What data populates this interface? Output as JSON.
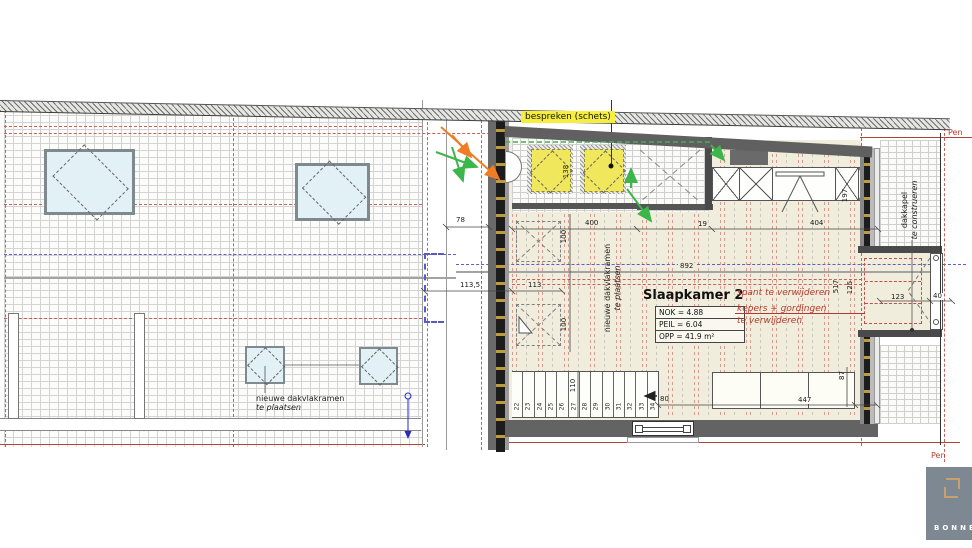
{
  "annotations": {
    "bespreken": "bespreken (schets)",
    "spant": "spant te verwijderen",
    "kepers_1": "kepers + gordingen",
    "kepers_2": "te verwijderen",
    "new_sky_1": "nieuwe dakvlakramen",
    "new_sky_2": "te plaatsen",
    "vert_sky_1": "nieuwe dakvlakramen",
    "vert_sky_2": "te plaatsen",
    "dakkapel_1": "dakkapel",
    "dakkapel_2": "te construeren",
    "boundary_top": "Pen",
    "boundary_bottom": "Pen"
  },
  "room": {
    "name": "Slaapkamer 2",
    "info": {
      "nok": "NOK = 4.88",
      "peil": "PEIL = 6.04",
      "opp": "OPP = 41.9 m²"
    }
  },
  "dimensions": {
    "w78": "78",
    "w113_5": "113,5",
    "w113": "113",
    "h138": "138",
    "h100_top": "100",
    "h100_bottom": "100",
    "w400": "400",
    "w19": "19",
    "w404": "404",
    "h197": "197",
    "w892": "892",
    "h110": "110",
    "w80": "80",
    "w447": "447",
    "h87": "87",
    "h517": "517",
    "h125": "125",
    "w123": "123",
    "w40": "40"
  },
  "stairs": {
    "treads": [
      "22",
      "23",
      "24",
      "25",
      "26",
      "27",
      "28",
      "29",
      "30",
      "31",
      "32",
      "33",
      "34"
    ]
  },
  "logo": {
    "text": "BONNE"
  },
  "colors": {
    "floor": "#f0eddc",
    "wall": "#606060",
    "highlight": "#f2e95c",
    "annotation_red": "#b5392c",
    "arrow_green": "#3cb54b",
    "arrow_orange": "#f07d23",
    "line_blue": "#6060c4",
    "logo_gray": "#7e8893",
    "logo_gold": "#c8a06a"
  }
}
